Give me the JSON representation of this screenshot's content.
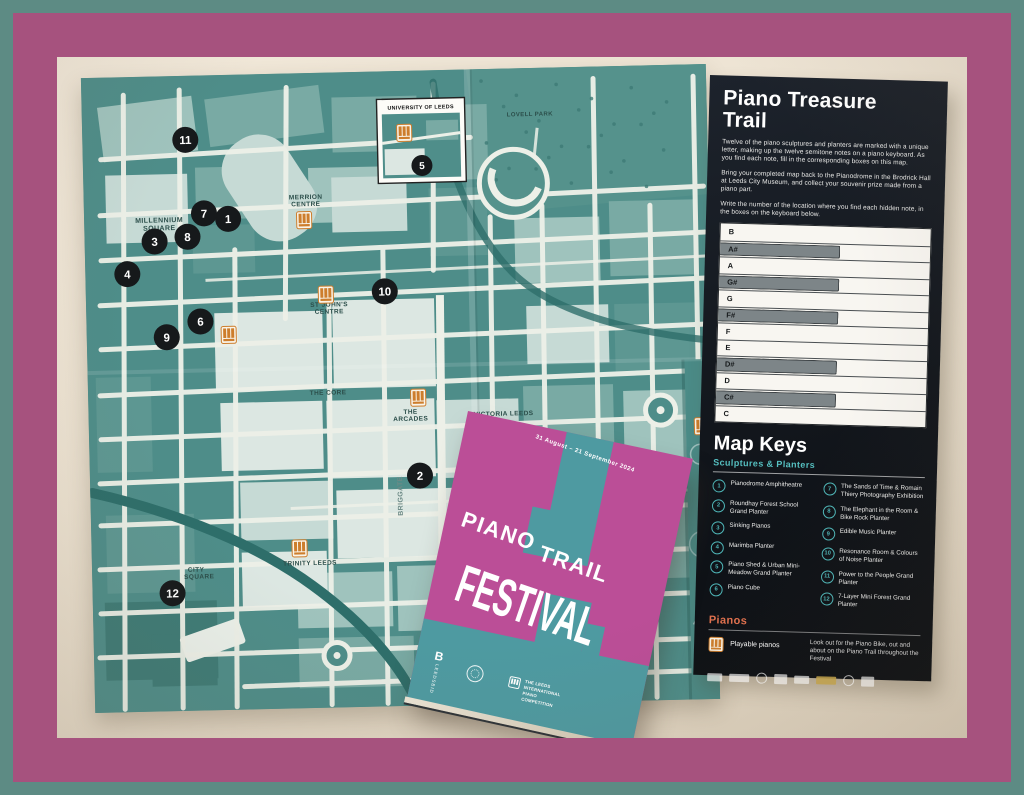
{
  "panel": {
    "title": "Piano Treasure Trail",
    "paragraphs": [
      "Twelve of the piano sculptures and planters are marked with a unique letter, making up the twelve semitone notes on a piano keyboard. As you find each note, fill in the corresponding boxes on this map.",
      "Bring your completed map back to the Pianodrome in the Brodrick Hall at Leeds City Museum, and collect your souvenir prize made from a piano part.",
      "Write the number of the location where you find each hidden note, in the boxes on the keyboard below."
    ],
    "keyboard": {
      "keys": [
        {
          "label": "B",
          "sharp": false
        },
        {
          "label": "A#",
          "sharp": true
        },
        {
          "label": "A",
          "sharp": false
        },
        {
          "label": "G#",
          "sharp": true
        },
        {
          "label": "G",
          "sharp": false
        },
        {
          "label": "F#",
          "sharp": true
        },
        {
          "label": "F",
          "sharp": false
        },
        {
          "label": "E",
          "sharp": false
        },
        {
          "label": "D#",
          "sharp": true
        },
        {
          "label": "D",
          "sharp": false
        },
        {
          "label": "C#",
          "sharp": true
        },
        {
          "label": "C",
          "sharp": false
        }
      ]
    },
    "map_keys": {
      "title": "Map Keys",
      "subtitle": "Sculptures & Planters",
      "items": [
        {
          "n": "1",
          "label": "Pianodrome Amphitheatre"
        },
        {
          "n": "2",
          "label": "Roundhay Forest School Grand Planter"
        },
        {
          "n": "3",
          "label": "Sinking Pianos"
        },
        {
          "n": "4",
          "label": "Marimba Planter"
        },
        {
          "n": "5",
          "label": "Piano Shed & Urban Mini-Meadow Grand Planter"
        },
        {
          "n": "6",
          "label": "Piano Cube"
        },
        {
          "n": "7",
          "label": "The Sands of Time & Romain Thiery Photography Exhibition"
        },
        {
          "n": "8",
          "label": "The Elephant in the Room & Bike Rock Planter"
        },
        {
          "n": "9",
          "label": "Edible Music Planter"
        },
        {
          "n": "10",
          "label": "Resonance Room & Colours of Noise Planter"
        },
        {
          "n": "11",
          "label": "Power to the People Grand Planter"
        },
        {
          "n": "12",
          "label": "7-Layer Mini Forest Grand Planter"
        }
      ]
    },
    "pianos": {
      "title": "Pianos",
      "icon": "playable-piano-icon",
      "label": "Playable pianos",
      "note": "Look out for the Piano Bike, out and about on the Piano Trail throughout the Festival"
    },
    "sponsors": [
      "sponsor-logo-1",
      "sponsor-logo-2",
      "sponsor-logo-3",
      "sponsor-logo-4",
      "sponsor-logo-5",
      "sponsor-logo-6",
      "sponsor-logo-7",
      "sponsor-logo-8"
    ]
  },
  "map": {
    "inset": {
      "title": "UNIVERSITY OF LEEDS",
      "marker_num": "5"
    },
    "markers": [
      {
        "n": "1",
        "x": 144,
        "y": 144
      },
      {
        "n": "2",
        "x": 330,
        "y": 405
      },
      {
        "n": "3",
        "x": 70,
        "y": 165
      },
      {
        "n": "4",
        "x": 42,
        "y": 197
      },
      {
        "n": "5",
        "x": 339,
        "y": 95,
        "r": 10.5
      },
      {
        "n": "6",
        "x": 114,
        "y": 246
      },
      {
        "n": "7",
        "x": 120,
        "y": 138
      },
      {
        "n": "8",
        "x": 103,
        "y": 161
      },
      {
        "n": "9",
        "x": 80,
        "y": 261
      },
      {
        "n": "10",
        "x": 299,
        "y": 220
      },
      {
        "n": "11",
        "x": 103,
        "y": 64
      },
      {
        "n": "12",
        "x": 80,
        "y": 517
      }
    ],
    "piano_icons": [
      {
        "x": 322,
        "y": 62
      },
      {
        "x": 220,
        "y": 147
      },
      {
        "x": 142,
        "y": 260
      },
      {
        "x": 240,
        "y": 222
      },
      {
        "x": 330,
        "y": 327
      },
      {
        "x": 208,
        "y": 475
      },
      {
        "x": 613,
        "y": 362
      }
    ],
    "labels": [
      {
        "text": "MILLENNIUM",
        "x": 75,
        "y": 146,
        "size": 7
      },
      {
        "text": "SQUARE",
        "x": 75,
        "y": 154,
        "size": 7
      },
      {
        "text": "MERRION",
        "x": 222,
        "y": 126,
        "size": 6.5
      },
      {
        "text": "CENTRE",
        "x": 222,
        "y": 133,
        "size": 6.5
      },
      {
        "text": "ST JOHN'S",
        "x": 243,
        "y": 234,
        "size": 6.5
      },
      {
        "text": "CENTRE",
        "x": 243,
        "y": 241,
        "size": 6.5
      },
      {
        "text": "THE CORE",
        "x": 240,
        "y": 322,
        "size": 6.5
      },
      {
        "text": "THE",
        "x": 322,
        "y": 343,
        "size": 6.5
      },
      {
        "text": "ARCADES",
        "x": 322,
        "y": 350,
        "size": 6.5
      },
      {
        "text": "VICTORIA LEEDS",
        "x": 415,
        "y": 347,
        "size": 6.5
      },
      {
        "text": "BRIGGATE",
        "x": 312,
        "y": 425,
        "size": 7,
        "rot": -90,
        "color": "#6d8a86"
      },
      {
        "text": "TRINITY LEEDS",
        "x": 218,
        "y": 492,
        "size": 6.5
      },
      {
        "text": "CITY",
        "x": 104,
        "y": 496,
        "size": 6.5
      },
      {
        "text": "SQUARE",
        "x": 107,
        "y": 503,
        "size": 6.5
      },
      {
        "text": "LOVELL PARK",
        "x": 448,
        "y": 48,
        "size": 6
      }
    ]
  },
  "booklet": {
    "dates": "31 August – 21 September 2024",
    "title_word1": "PIANO",
    "title_word2": "TRAIL",
    "subtitle": "FESTIVAL",
    "logos": {
      "leedsbid_initial": "B",
      "leedsbid": "LEEDSBID",
      "piano_competition": "THE LEEDS INTERNATIONAL PIANO COMPETITION"
    }
  },
  "colors": {
    "border_teal": "#5d8b84",
    "frame_mauve": "#a6527e",
    "desk_cream": "#ebe1d0",
    "map_teal": "#4e8d89",
    "panel_black": "#14191f",
    "accent_teal": "#55bfc0",
    "accent_coral": "#e2714e",
    "booklet_pink": "#bb4e97",
    "booklet_teal": "#4e9aa1",
    "marker_black": "#16191b",
    "piano_orange": "#cd7d2c"
  }
}
